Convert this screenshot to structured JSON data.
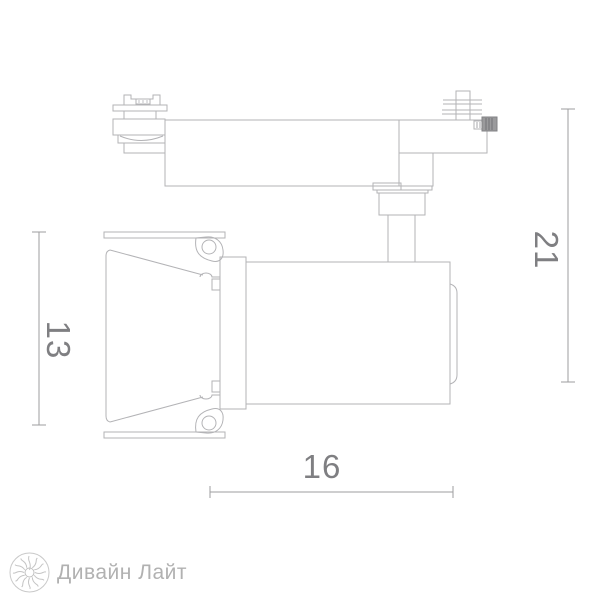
{
  "drawing": {
    "type": "technical-line-drawing",
    "subject": "track-mounted spotlight, side elevation",
    "line_color": "#b3b3b6",
    "dimension_line_color": "#9d9d9f",
    "dimension_text_color": "#7f7f82",
    "dimensions": {
      "shade_height": {
        "value": "13",
        "orientation": "vertical",
        "side": "left"
      },
      "overall_height": {
        "value": "21",
        "orientation": "vertical",
        "side": "right"
      },
      "body_length": {
        "value": "16",
        "orientation": "horizontal",
        "side": "bottom"
      }
    }
  },
  "logo": {
    "text": "Дивайн Лайт",
    "icon": "sunburst-logo-icon",
    "text_color": "#b1b1b1",
    "icon_color": "#c9c9c9"
  }
}
